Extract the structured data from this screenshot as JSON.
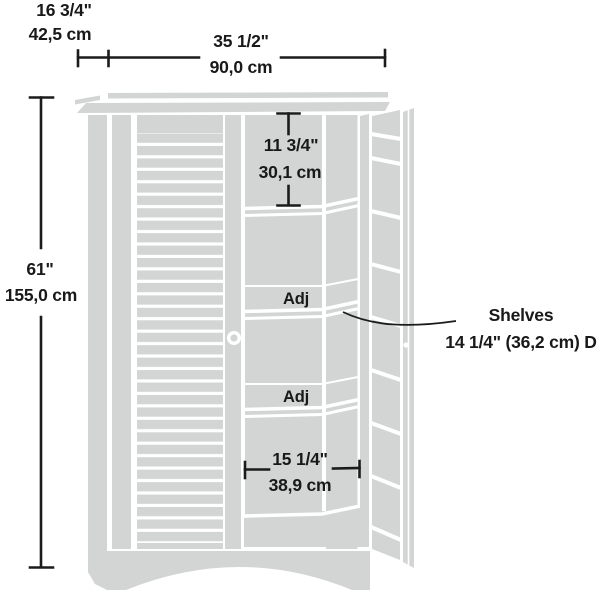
{
  "dimensions": {
    "depth": {
      "inches": "16 3/4\"",
      "cm": "42,5 cm"
    },
    "width": {
      "inches": "35 1/2\"",
      "cm": "90,0 cm"
    },
    "height": {
      "inches": "61\"",
      "cm": "155,0 cm"
    },
    "top_opening": {
      "inches": "11 3/4\"",
      "cm": "30,1 cm"
    },
    "bottom_opening": {
      "inches": "15 1/4\"",
      "cm": "38,9 cm"
    }
  },
  "shelf_labels": {
    "adjustable_1": "Adj",
    "adjustable_2": "Adj"
  },
  "callout": {
    "title": "Shelves",
    "detail": "14 1/4\" (36,2 cm) D"
  },
  "colors": {
    "background": "#ffffff",
    "cabinet_fill": "#d3d5d4",
    "line": "#1b1b1b",
    "text": "#191919"
  }
}
